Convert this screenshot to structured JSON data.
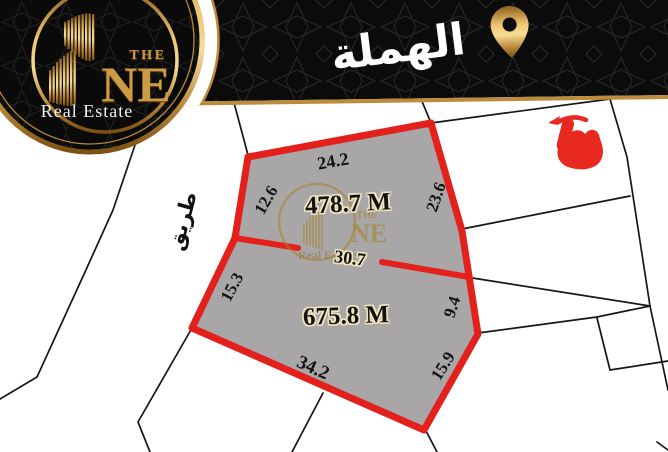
{
  "brand": {
    "word_the": "THE",
    "word_one": "NE",
    "tagline": "Real Estate"
  },
  "header": {
    "location_name": "الهملة"
  },
  "map": {
    "road_label": "طريق",
    "plot_upper": {
      "area": "478.7 M",
      "edge_top": "24.2",
      "edge_left": "12.6",
      "edge_right": "23.6",
      "edge_divider": "30.7"
    },
    "plot_lower": {
      "area": "675.8 M",
      "edge_left": "15.3",
      "edge_right_upper": "9.4",
      "edge_right_lower": "15.9",
      "edge_bottom": "34.2"
    }
  },
  "watermark": {
    "word_the": "THE",
    "word_one": "NE",
    "tagline": "Real Estate"
  },
  "colors": {
    "boundary_red": "#e3201b",
    "plot_fill": "#a8a6a7",
    "gold": "#c9973f",
    "header_black": "#0b0b0b"
  }
}
